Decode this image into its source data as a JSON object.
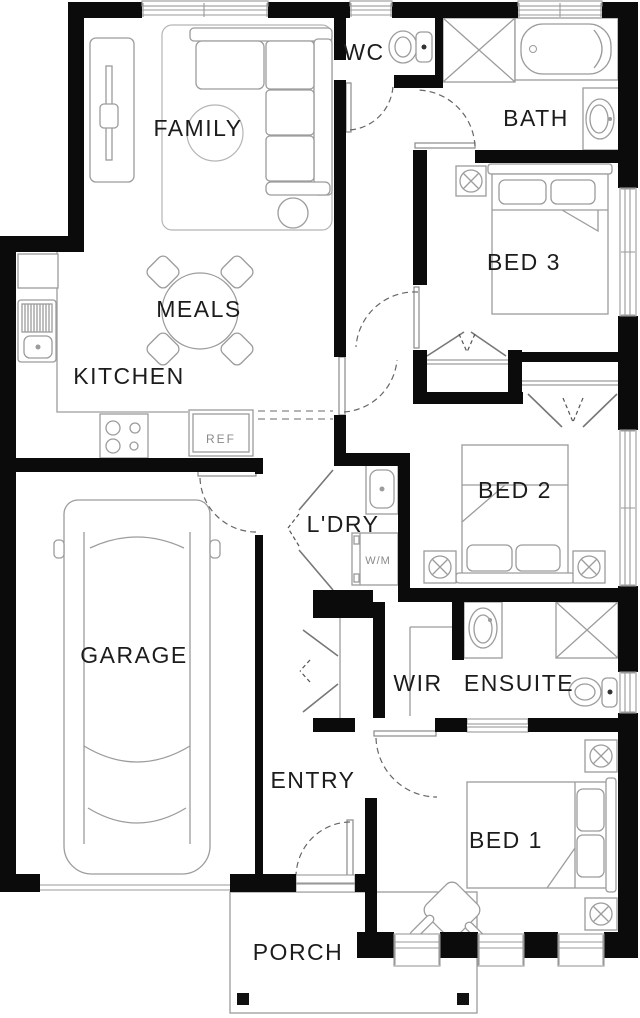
{
  "floor_plan": {
    "rooms": [
      {
        "id": "family",
        "label": "FAMILY"
      },
      {
        "id": "wc",
        "label": "WC"
      },
      {
        "id": "bath",
        "label": "BATH"
      },
      {
        "id": "bed3",
        "label": "BED 3"
      },
      {
        "id": "meals",
        "label": "MEALS"
      },
      {
        "id": "kitchen",
        "label": "KITCHEN"
      },
      {
        "id": "laundry",
        "label": "L'DRY"
      },
      {
        "id": "garage",
        "label": "GARAGE"
      },
      {
        "id": "bed2",
        "label": "BED 2"
      },
      {
        "id": "wir",
        "label": "WIR"
      },
      {
        "id": "ensuite",
        "label": "ENSUITE"
      },
      {
        "id": "entry",
        "label": "ENTRY"
      },
      {
        "id": "bed1",
        "label": "BED 1"
      },
      {
        "id": "porch",
        "label": "PORCH"
      }
    ],
    "appliances": {
      "fridge_label": "REF",
      "washer_label": "W/M"
    },
    "fixtures": [
      "sofa",
      "chaise",
      "round-rug",
      "area-rug",
      "tv-unit",
      "side-table",
      "dining-table",
      "dining-chairs",
      "kitchen-sink",
      "pantry",
      "cooktop",
      "fridge",
      "toilet",
      "shower",
      "bathtub",
      "vanity-basin",
      "double-bed",
      "pillows",
      "wardrobe-doors",
      "linen-doors",
      "laundry-tub",
      "washing-machine",
      "car",
      "armchair",
      "downlight",
      "porch-posts",
      "windows",
      "door-swings"
    ],
    "colors": {
      "walls": "#0b0b0b",
      "furniture_line": "#9c9c9c",
      "label_text": "#1c1c1c",
      "appliance_text": "#8a8a8a",
      "background": "#ffffff"
    }
  }
}
